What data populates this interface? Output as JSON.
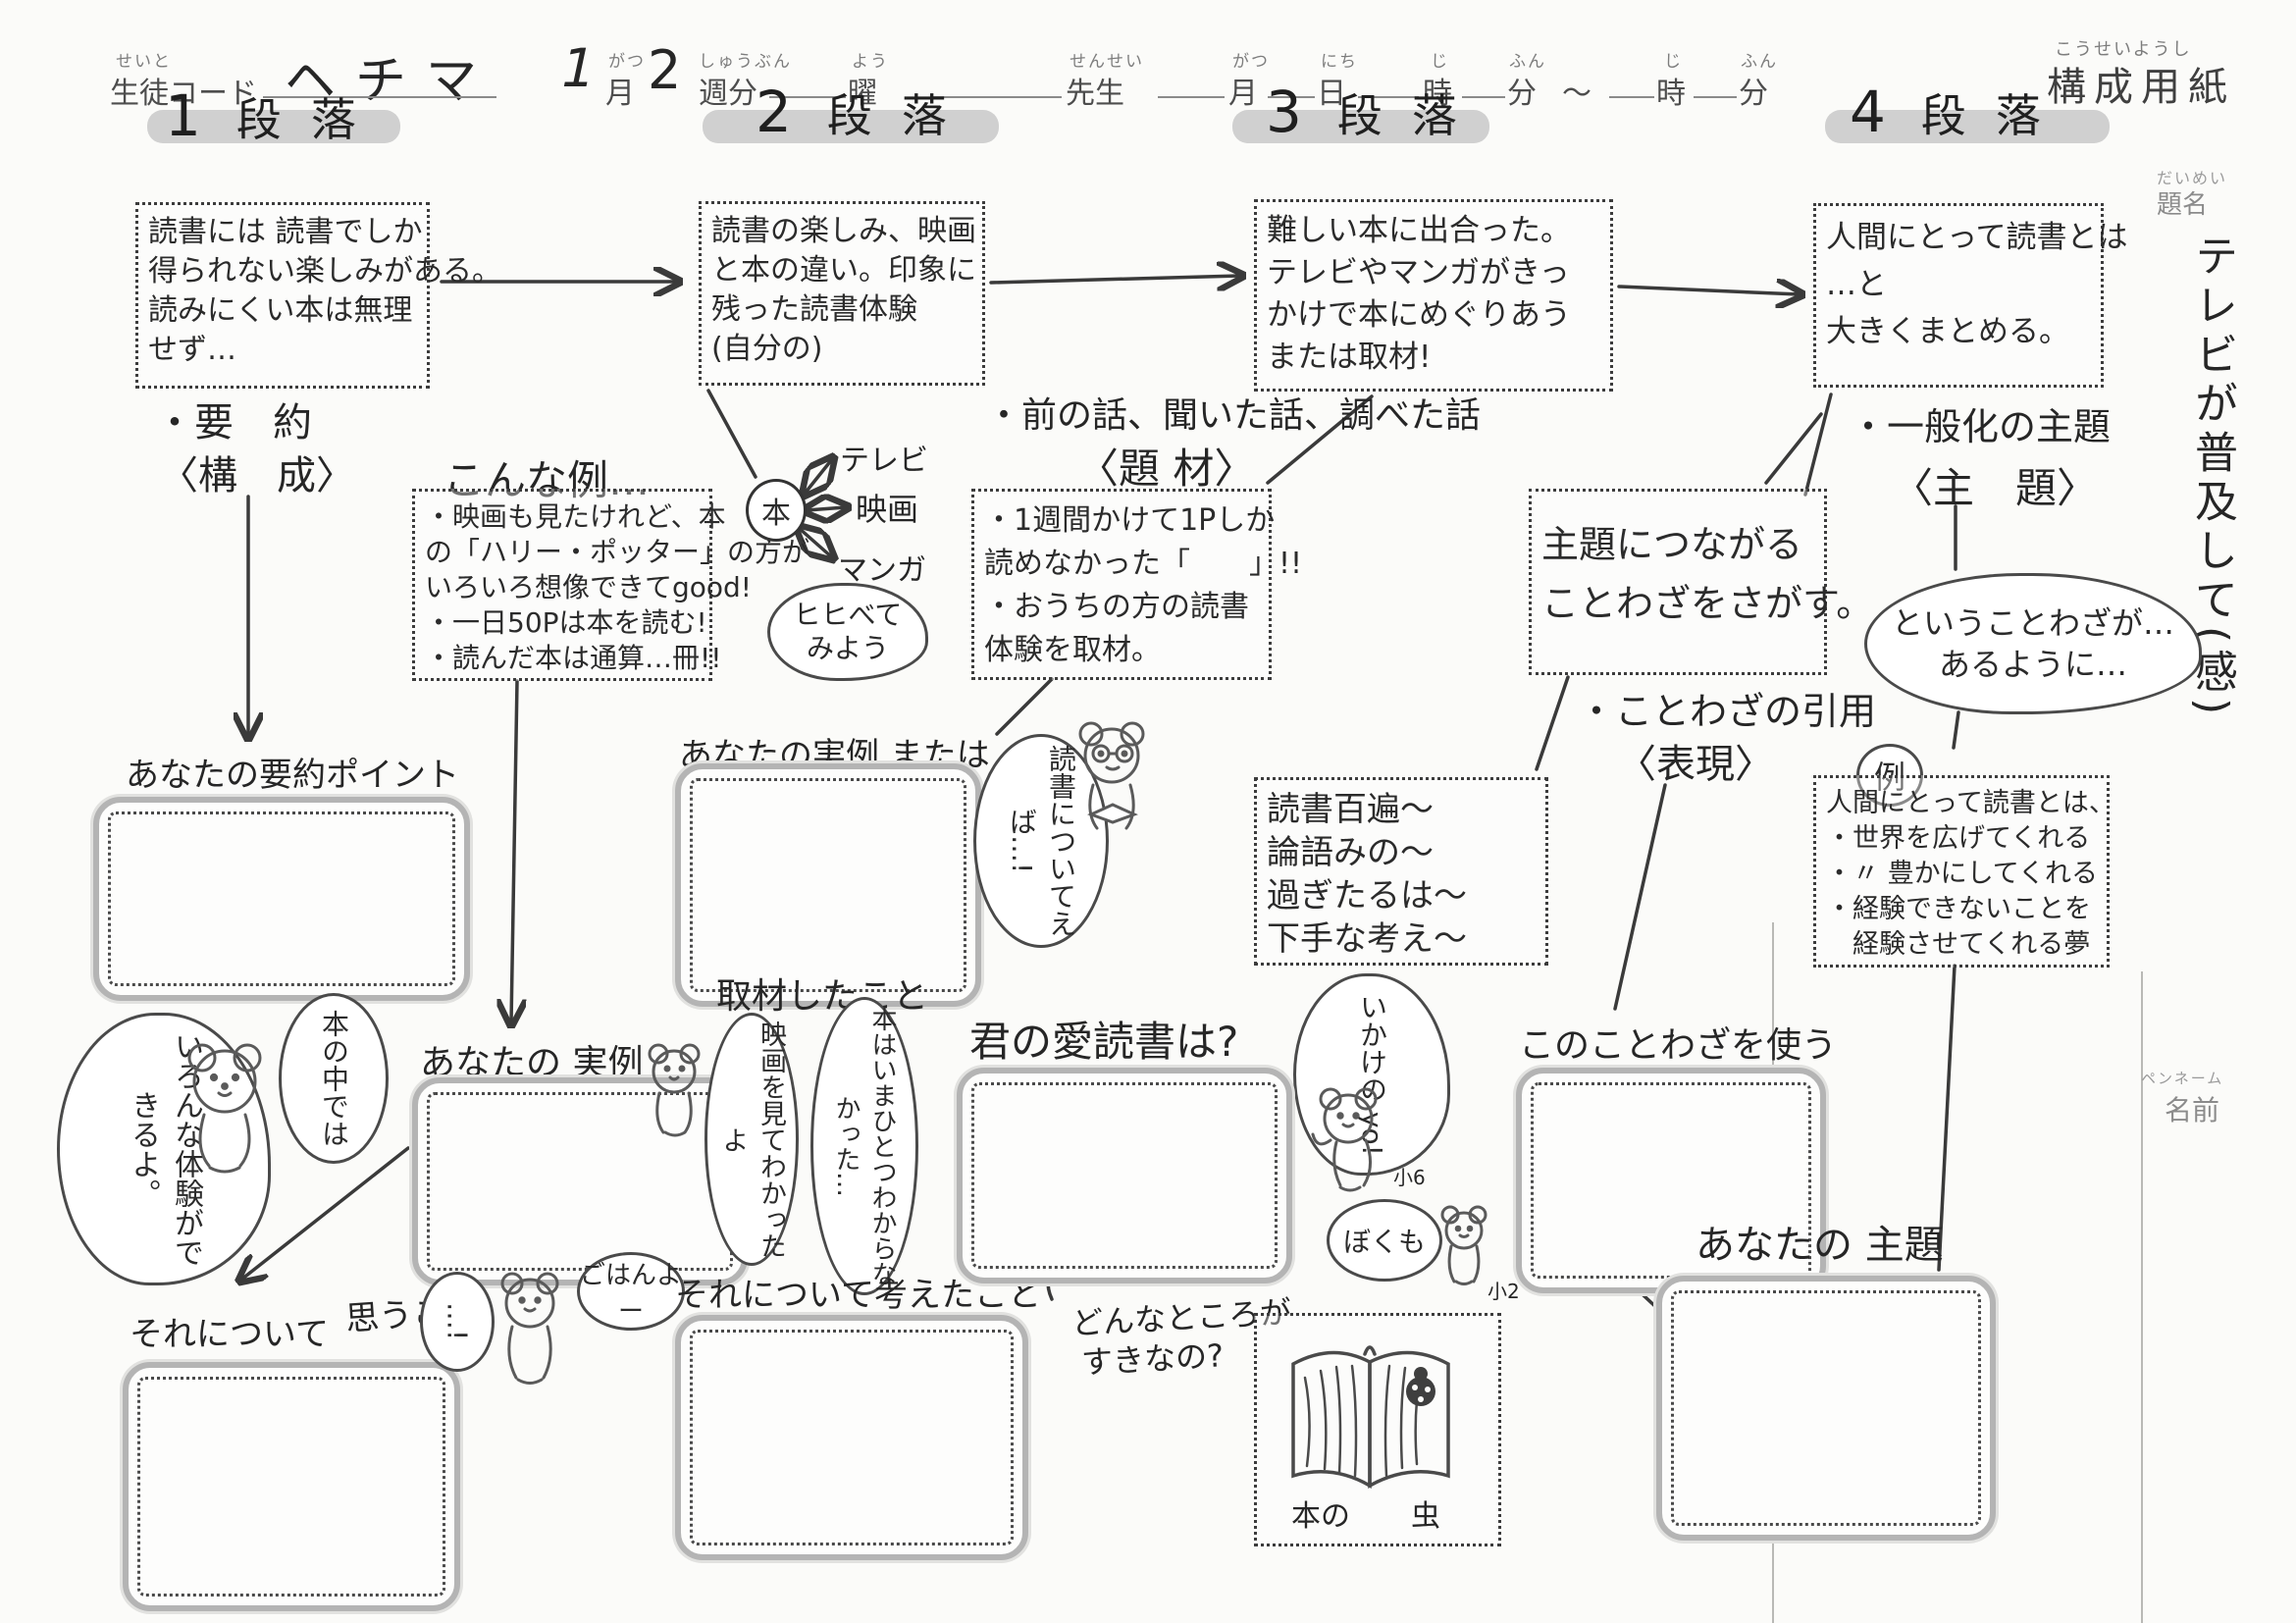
{
  "colors": {
    "highlight": "#c6c6c6",
    "ink": "#262626",
    "printed": "#4d4d4d",
    "pencil_gray": "#b4b4b4"
  },
  "header": {
    "furi": {
      "seito": "せいと",
      "gatsu": "がつ",
      "shubun": "しゅうぶん",
      "you": "よう",
      "sensei": "せんせい",
      "gatsu2": "がつ",
      "nichi": "にち",
      "ji": "じ",
      "fun": "ふん",
      "ji2": "じ",
      "fun2": "ふん",
      "kousei": "こうせいようし"
    },
    "seito_code": "生徒コード",
    "name_value": "ヘチマ",
    "month_value": "1",
    "month": "月",
    "week_value": "2",
    "week": "週分",
    "youbi": "曜",
    "sensei": "先生",
    "tsuki": "月",
    "hi": "日",
    "toki": "時",
    "pun": "分",
    "tilde": "〜",
    "toki2": "時",
    "pun2": "分",
    "sheet_title": "構成用紙"
  },
  "margin": {
    "daimei_furi": "だいめい",
    "daimei": "題名",
    "title_vertical": "テレビが普及して(感)",
    "penname_furi": "ペンネーム",
    "namae": "名前"
  },
  "danraku": {
    "d1num": "1",
    "d2num": "2",
    "d3num": "3",
    "d4num": "4",
    "label": "段落"
  },
  "box1": {
    "l0": "読書には 読書でしか",
    "l1": "得られない楽しみがある。",
    "l2": "読みにくい本は無理",
    "l3": "せず…"
  },
  "box2": {
    "l0": "読書の楽しみ、映画",
    "l1": "と本の違い。印象に",
    "l2": "残った読書体験",
    "l3": "(自分の)"
  },
  "box3": {
    "l0": "難しい本に出合った。",
    "l1": "テレビやマンガがきっ",
    "l2": "かけで本にめぐりあう",
    "l3": "または取材!"
  },
  "box4": {
    "l0": "人間にとって読書とは",
    "l1": "…と",
    "l2": "大きくまとめる。"
  },
  "col1": {
    "youyaku": "・要　約",
    "kousei": "〈構　成〉",
    "point_label": "あなたの要約ポイント",
    "taiken": "いろんな体験ができるよ。",
    "honno_naka": "本の中では",
    "jitsurei": "あなたの 実例",
    "sore1": "それについて",
    "omou": "思うこと"
  },
  "col2": {
    "konna": "こんな例…",
    "k0": "・映画も見たけれど、本",
    "k1": "の「ハリー・ポッター」の方が",
    "k2": "いろいろ想像できてgood!",
    "k3": "・一日50Pは本を読む!",
    "k4": "・読んだ本は通算…冊!!",
    "hon": "本",
    "tv": "テレビ",
    "eiga": "映画",
    "manga": "マンガ",
    "kurabe0": "ヒヒべて",
    "kurabe1": "みよう",
    "jitsurei_mata": "あなたの実例 または",
    "dokusho_bubble": "読書についてえば…!",
    "shuzai": "取材したこと",
    "eiga_bubble": "映画を見てわかったよ",
    "hon_bubble": "本はいまひとつわからなかった…",
    "gohan": "ごはんよー",
    "dots": "…!",
    "kangaeta": "それについて考えたこと"
  },
  "col3": {
    "mae": "・前の話、聞いた話、調べた話",
    "daizai": "〈題 材〉",
    "d0": "・1週間かけて1Pしか",
    "d1": "読めなかった「　　」!!",
    "d2": "・おうちの方の読書",
    "d3": "体験を取材。",
    "s0": "主題につながる",
    "s1": "ことわざをさがす。",
    "inyou": "・ことわざの引用",
    "hyougen": "〈表現〉",
    "kw0": "読書百遍〜",
    "kw1": "論語みの〜",
    "kw2": "過ぎたるは〜",
    "kw3": "下手な考え〜",
    "aidoku": "君の愛読書は?",
    "ikake": "いかけの yo!",
    "bokumo": "ぼくも",
    "sho6": "小6",
    "sho2": "小2",
    "donna0": "どんなところが",
    "donna1": "すきなの?",
    "honno": "本の",
    "mushi": "虫",
    "kono": "このことわざを使う"
  },
  "col4": {
    "ippanka": "・一般化の主題",
    "shudai": "〈主　題〉",
    "cloud0": "ということわざが…",
    "cloud1": "あるように…",
    "rei": "例",
    "r0": "人間にとって読書とは、",
    "r1": "・世界を広げてくれる",
    "r2": "・〃 豊かにしてくれる",
    "r3": "・経験できないことを",
    "r4": "　経験させてくれる夢",
    "anata_shudai": "あなたの 主題"
  }
}
